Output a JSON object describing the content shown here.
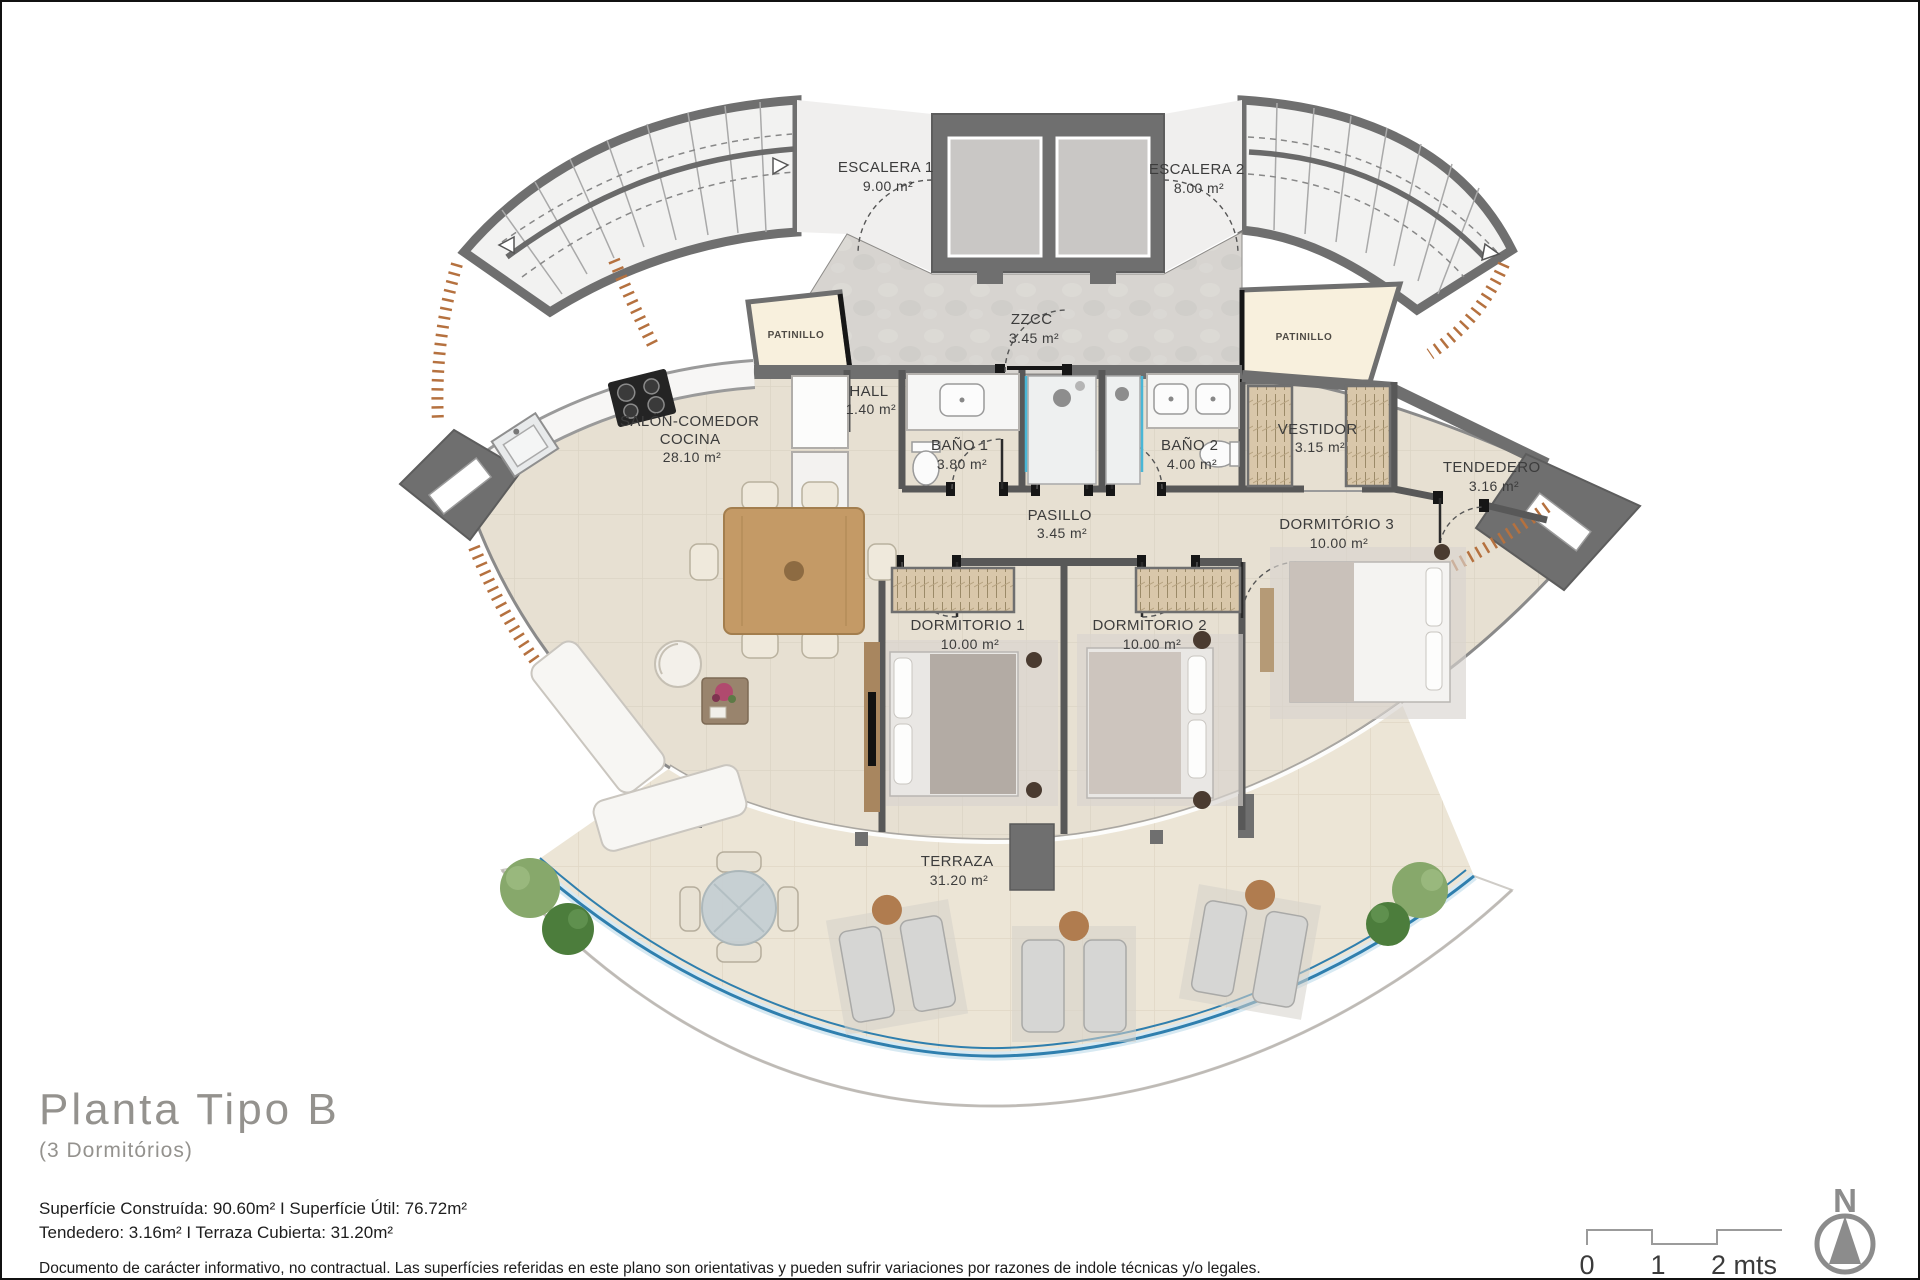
{
  "rooms": {
    "escalera1": {
      "name": "ESCALERA 1",
      "area": "9.00 m²"
    },
    "escalera2": {
      "name": "ESCALERA 2",
      "area": "8.00 m²"
    },
    "zzcc": {
      "name": "ZZCC",
      "area": "3.45 m²"
    },
    "patinillo_left": {
      "name": "PATINILLO"
    },
    "patinillo_right": {
      "name": "PATINILLO"
    },
    "hall": {
      "name": "HALL",
      "area": "1.40 m²"
    },
    "salon": {
      "name_line1": "SALÓN-COMEDOR",
      "name_line2": "COCINA",
      "area": "28.10 m²"
    },
    "bano1": {
      "name": "BAÑO 1",
      "area": "3.80 m²"
    },
    "bano2": {
      "name": "BAÑO 2",
      "area": "4.00 m²"
    },
    "vestidor": {
      "name": "VESTIDOR",
      "area": "3.15 m²"
    },
    "tendedero": {
      "name": "TENDEDERO",
      "area": "3.16 m²"
    },
    "pasillo": {
      "name": "PASILLO",
      "area": "3.45 m²"
    },
    "dormitorio1": {
      "name": "DORMITORIO 1",
      "area": "10.00 m²"
    },
    "dormitorio2": {
      "name": "DORMITORIO 2",
      "area": "10.00 m²"
    },
    "dormitorio3": {
      "name": "DORMITÓRIO 3",
      "area": "10.00 m²"
    },
    "terraza": {
      "name": "TERRAZA",
      "area": "31.20 m²"
    }
  },
  "title_block": {
    "title": "Planta Tipo B",
    "subtitle": "(3 Dormitórios)",
    "areas_line1": "Superfície Construída: 90.60m² I Superfície Útil: 76.72m²",
    "areas_line2": "Tendedero: 3.16m² I Terraza Cubierta: 31.20m²",
    "disclaimer": "Documento de carácter informativo, no contractual. Las superfícies referidas en este plano son orientativas y pueden sufrir variaciones por razones de indole técnicas y/o legales."
  },
  "scale_bar": {
    "labels": [
      "0",
      "1",
      "2 mts"
    ]
  },
  "compass": {
    "north_label": "N"
  },
  "colors": {
    "wall": "#6f6f6f",
    "partition": "#585858",
    "floor_interior": "#e7e0d2",
    "floor_terrace": "#ece5d6",
    "floor_stairs": "#f2f2f1",
    "floor_zzcc": "#d7d4d0",
    "patinillo": "#f8f0dd",
    "balustrade_blue": "#2f7fae",
    "window_hatch_brown": "#b5713f",
    "wood": "#b07c4f",
    "wardrobe_tan": "#d9c7aa",
    "label_text": "#3c3c3c",
    "title_gray": "#94928e"
  }
}
